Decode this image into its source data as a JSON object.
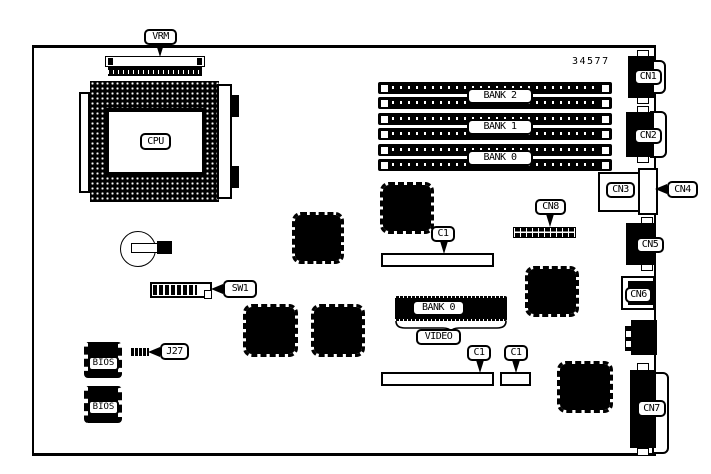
{
  "diagram": {
    "figure_number": "34577",
    "colors": {
      "ink": "#000000",
      "paper": "#ffffff"
    },
    "cpu": {
      "socket_label": "CPU",
      "vrm_label": "VRM"
    },
    "memory": {
      "banks": [
        {
          "label": "BANK 2"
        },
        {
          "label": "BANK 1"
        },
        {
          "label": "BANK 0"
        }
      ]
    },
    "video": {
      "module_label": "BANK 0",
      "caption": "VIDEO"
    },
    "connectors": {
      "cn1": "CN1",
      "cn2": "CN2",
      "cn3": "CN3",
      "cn4": "CN4",
      "cn5": "CN5",
      "cn6": "CN6",
      "cn7": "CN7",
      "cn8": "CN8"
    },
    "cache_slots": [
      {
        "label": "C1"
      },
      {
        "label": "C1"
      },
      {
        "label": "C1"
      }
    ],
    "switch": {
      "label": "SW1"
    },
    "jumper": {
      "label": "J27"
    },
    "bios_chips": [
      {
        "label": "BIOS"
      },
      {
        "label": "BIOS"
      }
    ]
  }
}
